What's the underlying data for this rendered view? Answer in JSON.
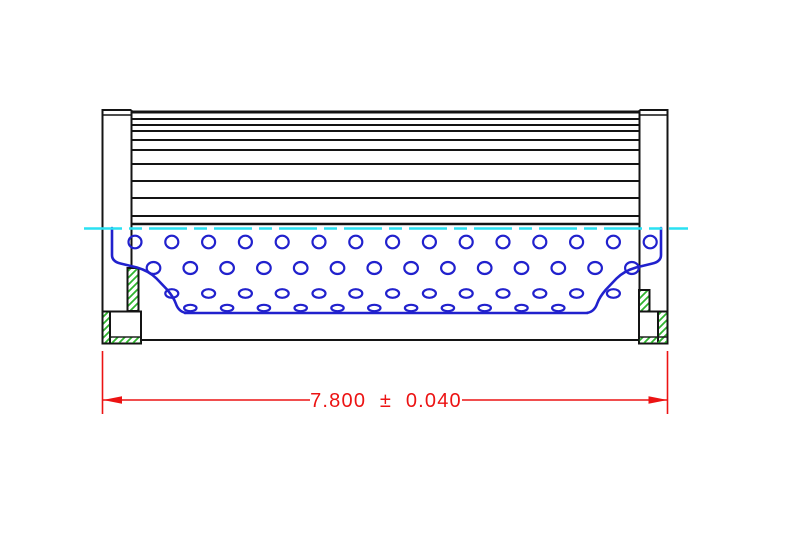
{
  "page": {
    "background": "#ffffff"
  },
  "drawing": {
    "name": "filter-element-side-cross-section",
    "colors": {
      "outline": "#141414",
      "core": "#2121cd",
      "centerline": "#2ae1f2",
      "hatch": "#2eb42e",
      "dimension": "#ec1313",
      "background": "#ffffff"
    },
    "dimension": {
      "label": "7.800 ± 0.040",
      "value": "7.800",
      "tolerance": "0.040"
    },
    "pleats": {
      "x1": 132,
      "x2": 640,
      "top_y": 112,
      "bottom_y": 224,
      "line_ys": [
        119,
        125,
        131,
        140,
        150,
        164,
        181,
        198,
        216
      ]
    },
    "perforation": {
      "spacing": 36.8,
      "rows": [
        {
          "cy": 242,
          "rx": 6.5,
          "ry": 6.3,
          "x_start": 135,
          "count": 15
        },
        {
          "cy": 268,
          "rx": 6.8,
          "ry": 6.0,
          "x_start": 153.5,
          "count": 14
        },
        {
          "cy": 293.5,
          "rx": 6.5,
          "ry": 4.3,
          "x_start": 171.8,
          "count": 13
        },
        {
          "cy": 308,
          "rx": 6.2,
          "ry": 3.2,
          "x_start": 190.3,
          "count": 11
        }
      ]
    },
    "centerline": {
      "y": 228.5,
      "x_start": 84,
      "x_end": 688,
      "dash": "38 7 13 7"
    }
  }
}
